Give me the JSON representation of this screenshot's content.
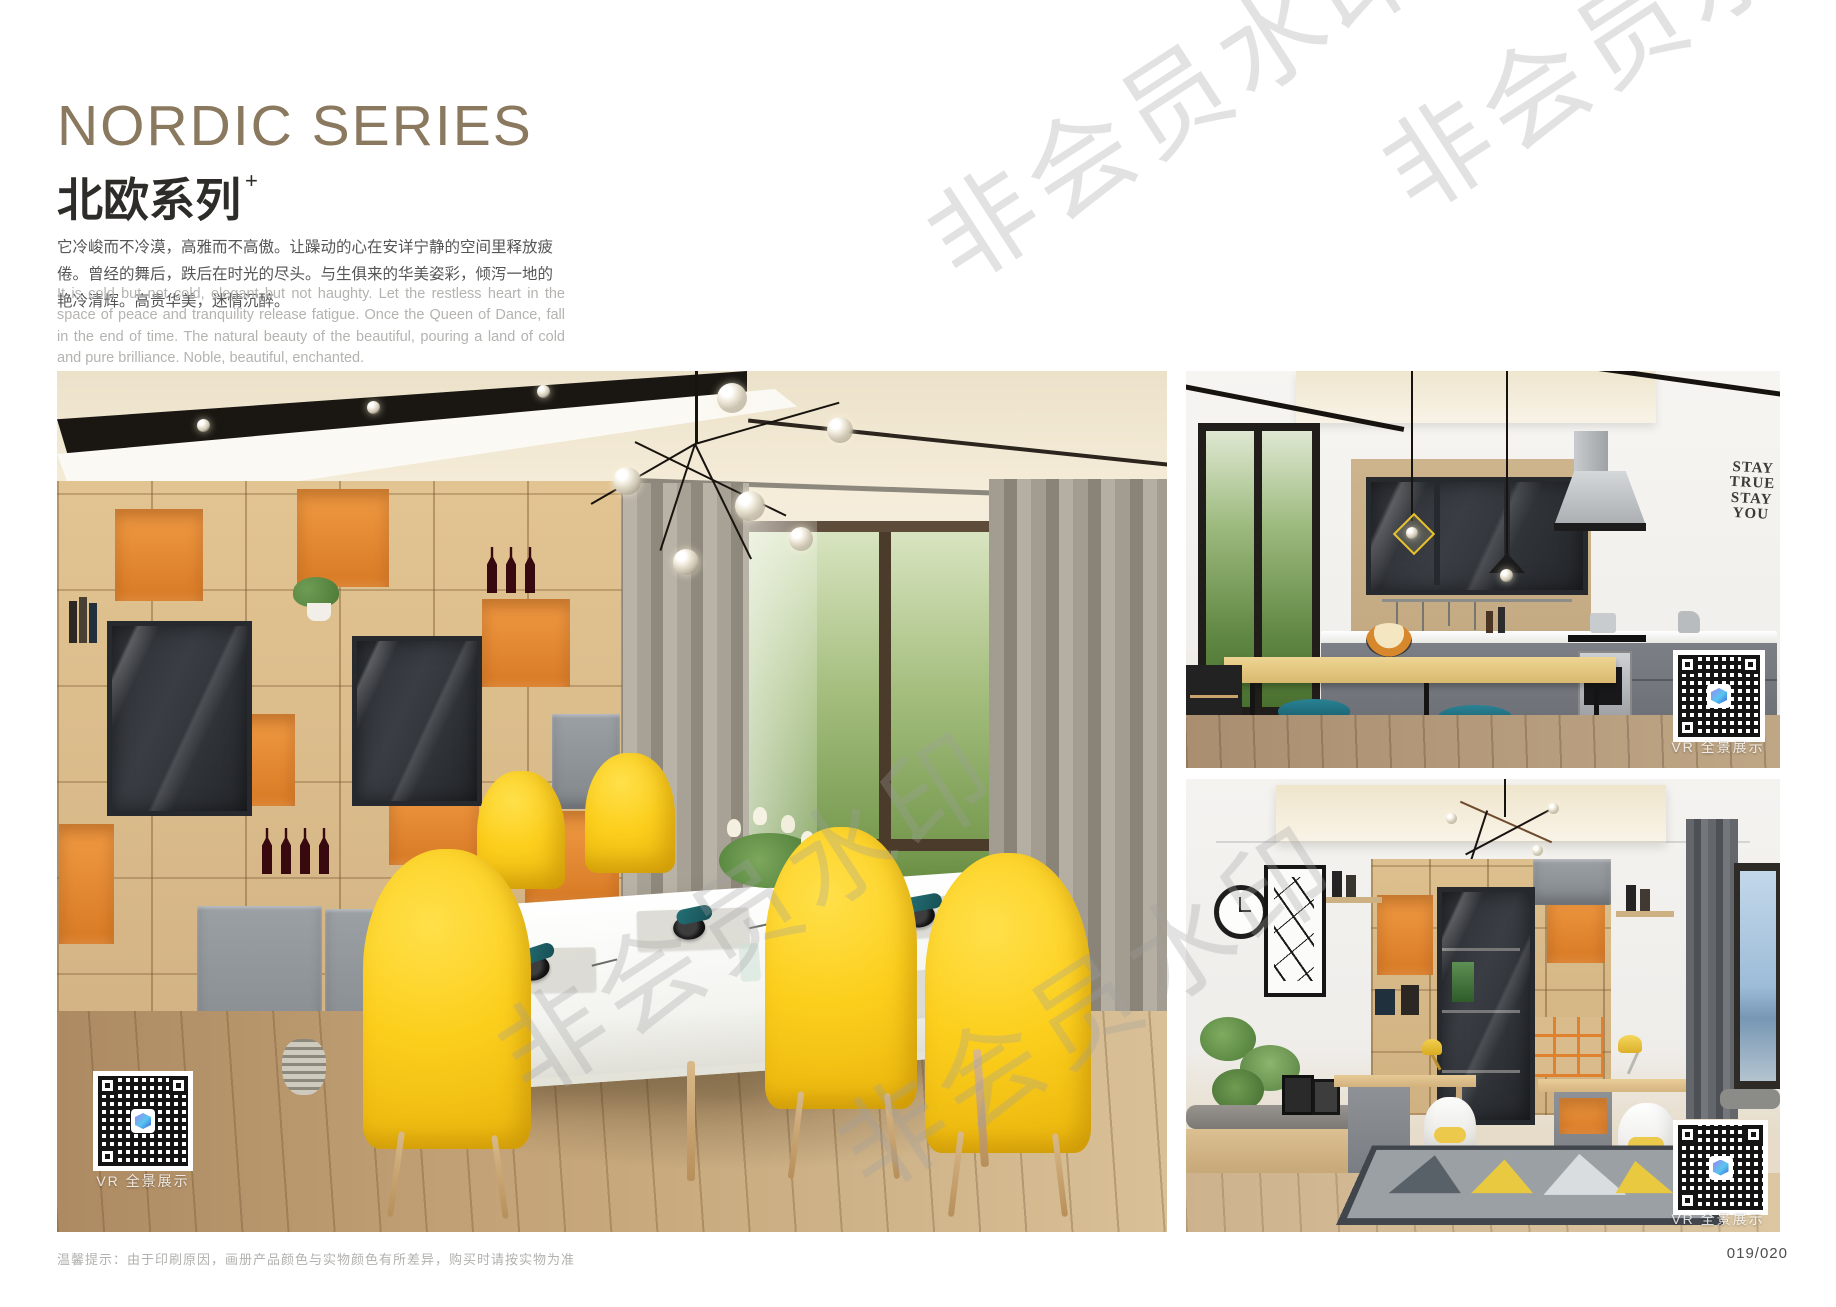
{
  "header": {
    "title_en": "NORDIC SERIES",
    "title_zh": "北欧系列",
    "title_sup": "+",
    "desc_zh": "它冷峻而不冷漠，高雅而不高傲。让躁动的心在安详宁静的空间里释放疲倦。曾经的舞后，跌后在时光的尽头。与生俱来的华美姿彩，倾泻一地的艳冷清辉。高贵华美，迷情沉醉。",
    "desc_en": "It is cold but not cold, elegant but not haughty. Let the restless heart in the space of peace and tranquility release fatigue. Once the Queen of Dance, fall in the end of time. The natural beauty of the beautiful, pouring a land of cold and pure brilliance. Noble, beautiful, enchanted."
  },
  "watermark": {
    "text": "非会员水印"
  },
  "photos": {
    "dining": {
      "vr_label": "VR 全景展示"
    },
    "kitchen": {
      "vr_label": "VR 全景展示",
      "decal": [
        "STAY",
        "TRUE",
        "STAY",
        "YOU"
      ]
    },
    "study": {
      "vr_label": "VR 全景展示"
    }
  },
  "footer": {
    "note": "温馨提示：由于印刷原因，画册产品颜色与实物颜色有所差异，购买时请按实物为准",
    "page_number": "019/020"
  },
  "colors": {
    "title_bronze": "#8a795f",
    "accent_orange": "#e0812f",
    "chair_yellow": "#f7c81d",
    "stool_teal": "#1d6f80",
    "qr_logo_blue": "#58c6ef"
  }
}
